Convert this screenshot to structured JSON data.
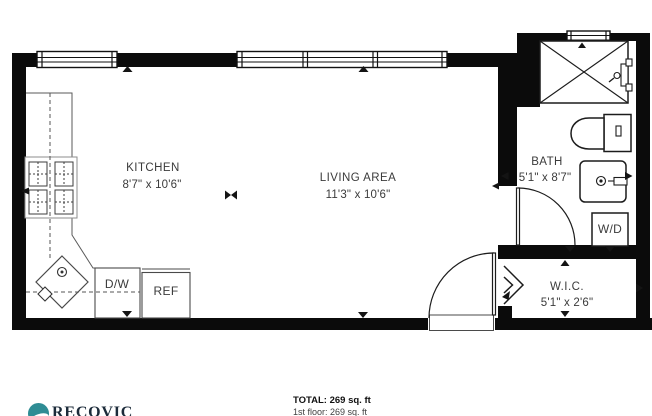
{
  "floorplan": {
    "rooms": {
      "kitchen": {
        "name": "KITCHEN",
        "dims": "8'7\" x 10'6\""
      },
      "living": {
        "name": "LIVING AREA",
        "dims": "11'3\" x 10'6\""
      },
      "bath": {
        "name": "BATH",
        "dims": "5'1\" x 8'7\""
      },
      "wic": {
        "name": "W.I.C.",
        "dims": "5'1\" x 2'6\""
      }
    },
    "appliances": {
      "dishwasher": "D/W",
      "refrigerator": "REF",
      "washer_dryer": "W/D"
    }
  },
  "footer": {
    "total": "TOTAL: 269 sq. ft",
    "floor": "1st floor: 269 sq. ft",
    "brand": "RECOVIC"
  },
  "colors": {
    "wall": "#0b0b0b",
    "line": "#1c1c1c",
    "text": "#3b3b3b",
    "brand_teal": "#2e8c94",
    "brand_navy": "#1c2b3a"
  }
}
